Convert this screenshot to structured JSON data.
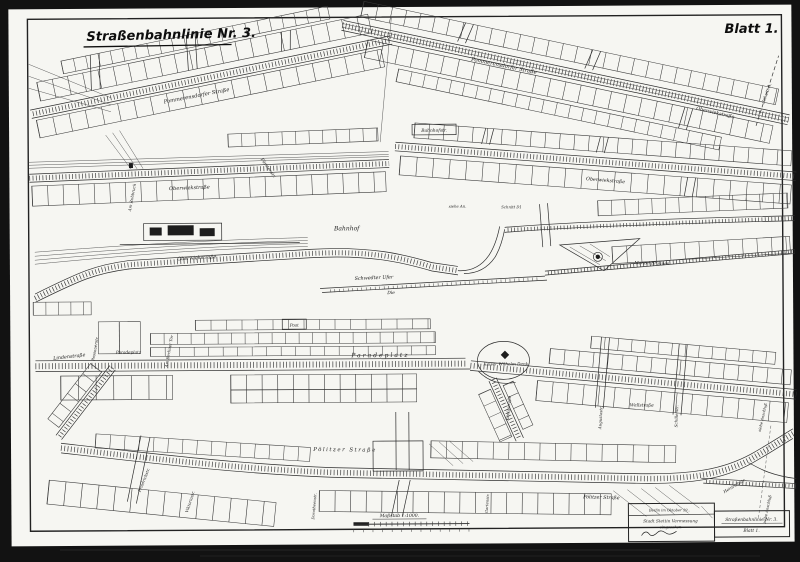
{
  "page": {
    "title": "Straßenbahnlinie Nr. 3.",
    "sheet": "Blatt 1."
  },
  "scale": {
    "label": "Maßstab 1:1000."
  },
  "title_block": {
    "date": "Berlin im Oktober 19..",
    "office_line1": "Stadt Stettin Vermessung",
    "office_line2": "eingesehen",
    "ref_title": "Straßenbahnlinie Nr. 3.",
    "ref_sheet": "Blatt 1."
  },
  "streets": {
    "labels": [
      "Pommerensdorfer Straße",
      "Pommerensdorfer Straße",
      "Oberwiekstraße",
      "Schnitt A.",
      "Oberwiekstraße",
      "Am Ruhbruch",
      "Fürstenstr.",
      "Bahnhofstr.",
      "Oberwiekstraße",
      "siehe An.",
      "Schnitt D1",
      "Bahnhof",
      "Oberwiekstraße",
      "Schwedter Ufer",
      "Die",
      "Manzel Brunnen",
      "Lindenstraße",
      "Passauerstr.",
      "Am Berliner Tor",
      "Paradeplatz",
      "Post",
      "Paradeplatz",
      "Kaiser Wilhelm Denk.",
      "Königstraße",
      "Augustastr.",
      "Wallstraße",
      "Schillerstr.",
      "siehe Anschluß",
      "Pölitzer Straße",
      "Friedrichstr.",
      "Viktoriastr.",
      "Dorotheenstr.",
      "Gartenstr.",
      "Pölitzer Straße",
      "Heinrichstr.",
      "siehe Anschluß"
    ]
  },
  "palette": {
    "paper": "#f6f6f2",
    "ink": "#2e2e2e",
    "photo_background": "#121212"
  }
}
